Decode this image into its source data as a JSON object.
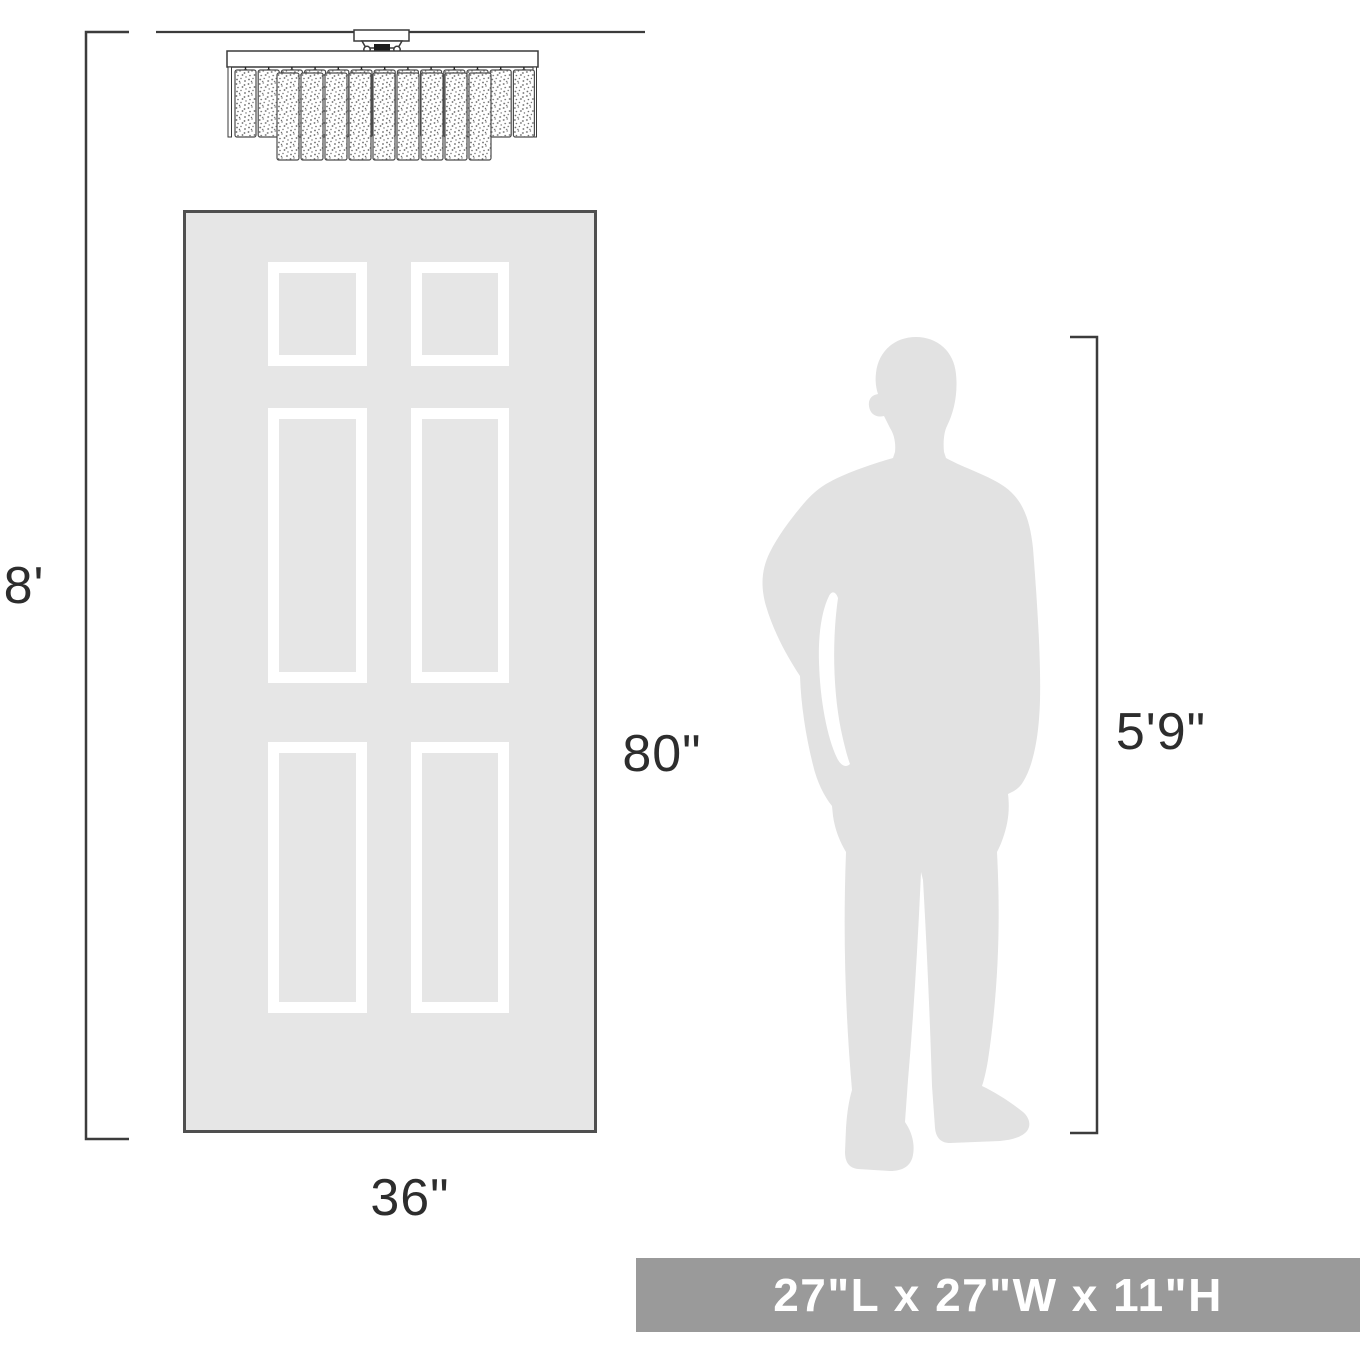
{
  "page": {
    "type": "product-size-comparison-diagram",
    "background": "#ffffff"
  },
  "labels": {
    "ceiling_height": "8'",
    "door_height": "80\"",
    "door_width": "36\"",
    "person_height": "5'9\""
  },
  "banner": {
    "text": "27\"L x 27\"W x 11\"H"
  },
  "reference_objects": {
    "fixture": "crystal-flush-mount-ceiling-light",
    "door": "six-panel-door",
    "person": "standing-man-silhouette"
  },
  "colors": {
    "line_color": "#3c3c3c",
    "door_fill": "#e6e6e6",
    "door_border": "#4f4f4f",
    "panel_frame": "#ffffff",
    "silhouette_fill": "#e2e2e2",
    "banner_bg": "#9a9a9a",
    "banner_text": "#ffffff"
  }
}
